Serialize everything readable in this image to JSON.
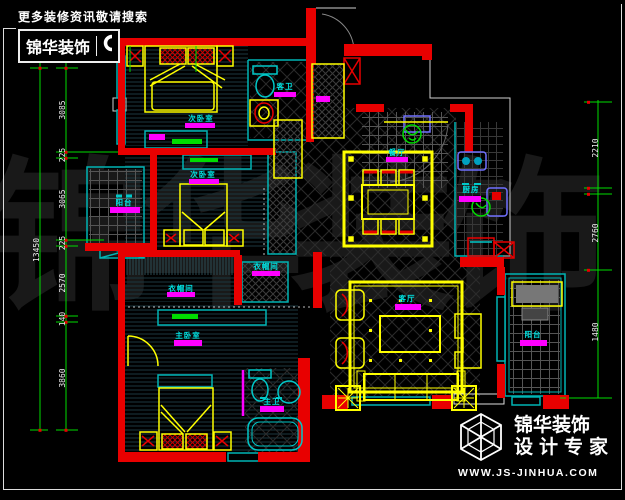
{
  "header": {
    "tagline": "更多装修资讯敬请搜索",
    "brand": "锦华装饰"
  },
  "big_watermark": "锦华装饰",
  "footer": {
    "brand": "锦华装饰",
    "subtitle": "设计专家",
    "website": "WWW.JS-JINHUA.COM"
  },
  "rooms": [
    {
      "name": "次卧室"
    },
    {
      "name": "次卧室"
    },
    {
      "name": "阳台"
    },
    {
      "name": "衣帽间"
    },
    {
      "name": "衣帽间"
    },
    {
      "name": "主卧室"
    },
    {
      "name": "客卫"
    },
    {
      "name": "主卫"
    },
    {
      "name": "餐厅"
    },
    {
      "name": "厨房"
    },
    {
      "name": "客厅"
    },
    {
      "name": "阳台"
    }
  ],
  "dims": {
    "left": {
      "total": "13450",
      "segments": [
        "3085",
        "225",
        "3065",
        "225",
        "2570",
        "140",
        "3860"
      ]
    },
    "right": {
      "segments": [
        "2210",
        "2760",
        "1480"
      ]
    }
  },
  "colors": {
    "wall": "#e80000",
    "furniture": "#ffff00",
    "fixture": "#00c8c8",
    "label_text": "#00e0e0",
    "label_bar": "#ff00ff",
    "dimension": "#00dd00",
    "decor": "#00dd00",
    "brand_text": "#ffffff"
  }
}
